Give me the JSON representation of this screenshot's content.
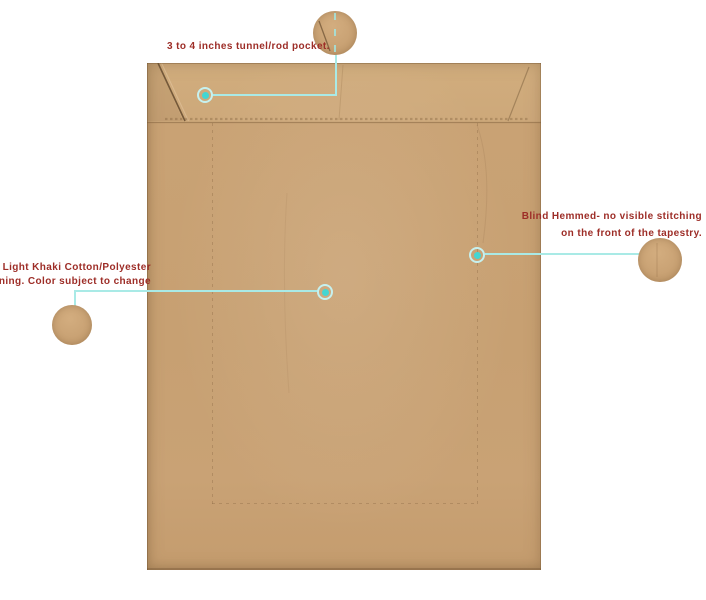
{
  "annotations": {
    "rod_pocket": {
      "text": "3 to 4 inches tunnel/rod pocket."
    },
    "lining": {
      "line1": "Light Khaki Cotton/Polyester",
      "line2": "lining. Color subject to change"
    },
    "blind_hem": {
      "line1": "Blind Hemmed- no visible stitching",
      "line2": "on the front of the tapestry."
    }
  },
  "icons": {
    "hotspot_marker": "teal-dot-with-halo-ring",
    "detail_circle": "magnified-fabric-swatch"
  },
  "colors": {
    "label_text": "#9d2d27",
    "leader_line": "#a9eae6",
    "marker_ring": "#c6f1ef",
    "marker_dot": "#43d6d2",
    "fabric_base": "#c7a075",
    "fabric_band": "#cca77a"
  }
}
